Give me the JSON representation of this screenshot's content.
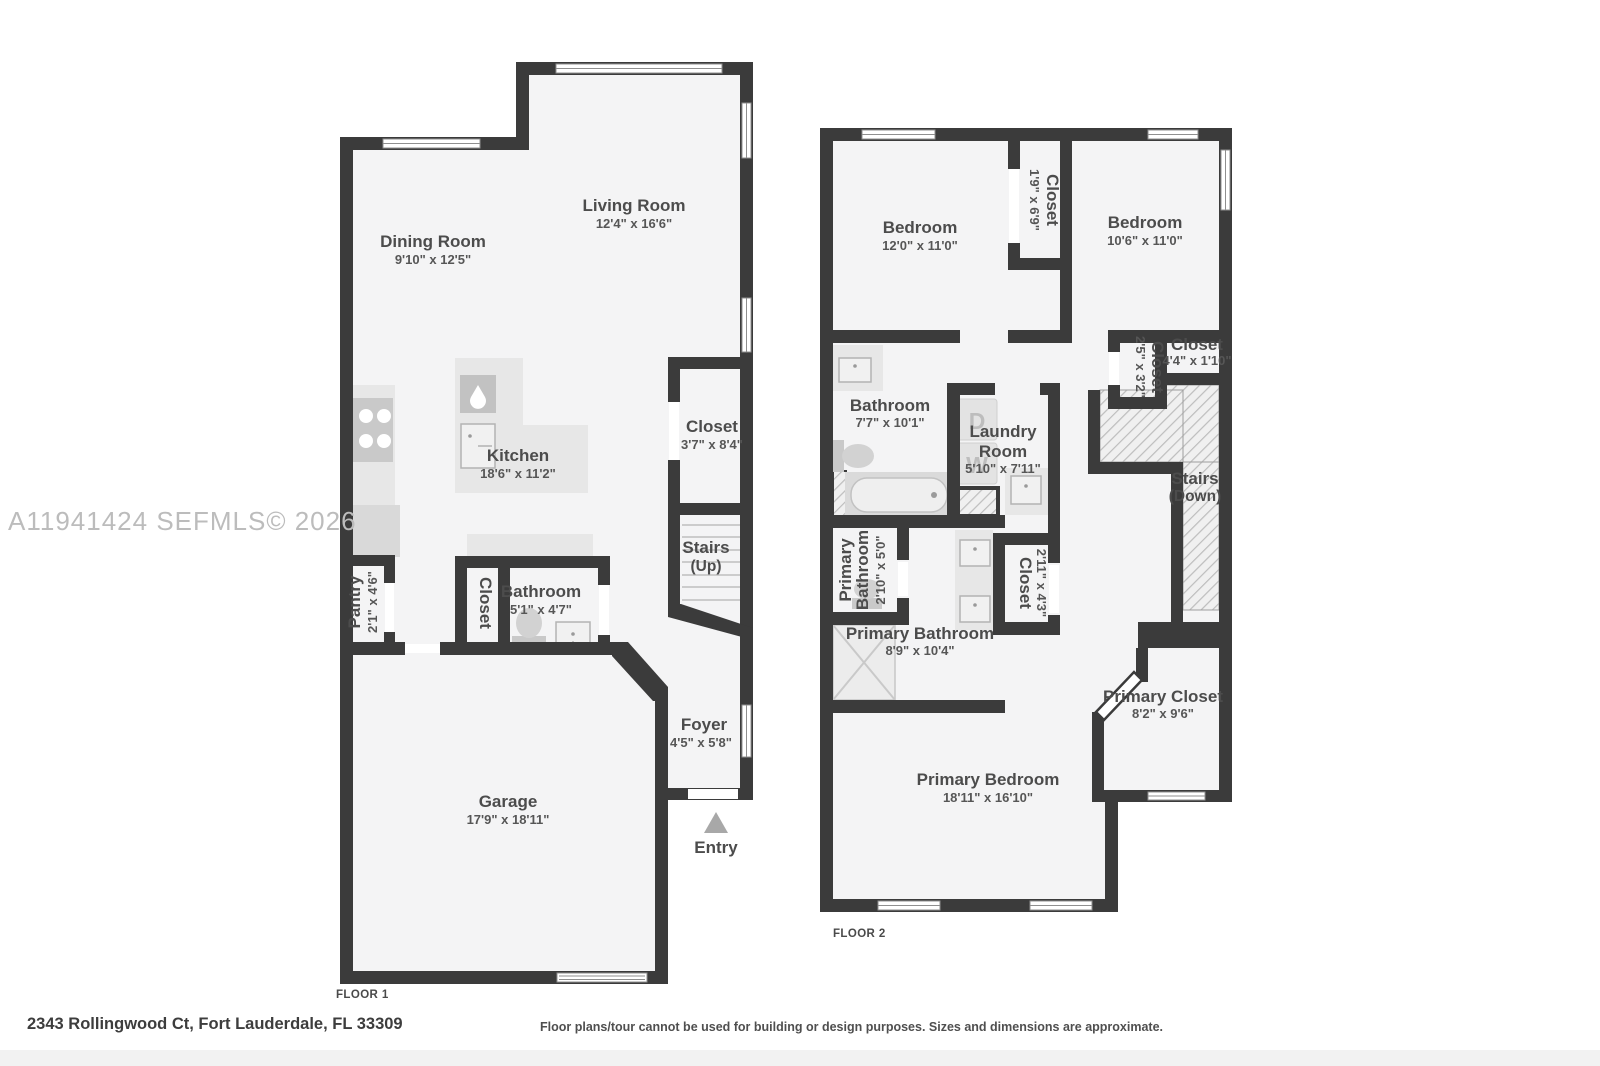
{
  "watermark": "A11941424  SEFMLS© 2026",
  "address": "2343 Rollingwood Ct, Fort Lauderdale, FL 33309",
  "disclaimer": "Floor plans/tour cannot be used for building or design purposes. Sizes and dimensions are approximate.",
  "colors": {
    "wall": "#3b3b3b",
    "room": "#f4f4f5",
    "label": "#4c4c4c",
    "watermark": "#bcbcbc"
  },
  "floor1": {
    "label": "FLOOR 1",
    "rooms": {
      "dining": {
        "name": "Dining Room",
        "dims": "9'10\" x 12'5\""
      },
      "living": {
        "name": "Living Room",
        "dims": "12'4\" x 16'6\""
      },
      "kitchen": {
        "name": "Kitchen",
        "dims": "18'6\" x 11'2\""
      },
      "closet": {
        "name": "Closet",
        "dims": "3'7\" x 8'4\""
      },
      "stairs": {
        "name": "Stairs",
        "dir": "(Up)"
      },
      "pantry": {
        "name": "Pantry",
        "dims": "2'1\" x 4'6\""
      },
      "hall_closet": {
        "name": "Closet"
      },
      "bathroom": {
        "name": "Bathroom",
        "dims": "5'1\" x 4'7\""
      },
      "foyer": {
        "name": "Foyer",
        "dims": "4'5\" x 5'8\""
      },
      "garage": {
        "name": "Garage",
        "dims": "17'9\" x 18'11\""
      },
      "entry": {
        "name": "Entry"
      }
    }
  },
  "floor2": {
    "label": "FLOOR 2",
    "rooms": {
      "bedroom_left": {
        "name": "Bedroom",
        "dims": "12'0\" x 11'0\""
      },
      "closet_center": {
        "name": "Closet",
        "dims": "1'9\" x 6'9\""
      },
      "bedroom_right": {
        "name": "Bedroom",
        "dims": "10'6\" x 11'0\""
      },
      "bathroom": {
        "name": "Bathroom",
        "dims": "7'7\" x 10'1\""
      },
      "laundry": {
        "name": "Laundry",
        "name2": "Room",
        "dims": "5'10\" x 7'11\""
      },
      "closet_small": {
        "name": "Closet",
        "dims": "2'5\" x 3'2\""
      },
      "closet_wide": {
        "name": "Closet",
        "dims": "4'4\" x 1'10\""
      },
      "stairs": {
        "name": "Stairs",
        "dir": "(Down)"
      },
      "wc": {
        "name": "Primary",
        "name2": "Bathroom",
        "dims": "2'10\" x 5'0\""
      },
      "primary_bathroom": {
        "name": "Primary Bathroom",
        "dims": "8'9\" x 10'4\""
      },
      "closet_mid": {
        "name": "Closet",
        "dims": "2'11\" x 4'3\""
      },
      "primary_closet": {
        "name": "Primary Closet",
        "dims": "8'2\" x 9'6\""
      },
      "primary_bedroom": {
        "name": "Primary Bedroom",
        "dims": "18'11\" x 16'10\""
      },
      "washer": "W",
      "dryer": "D"
    }
  }
}
